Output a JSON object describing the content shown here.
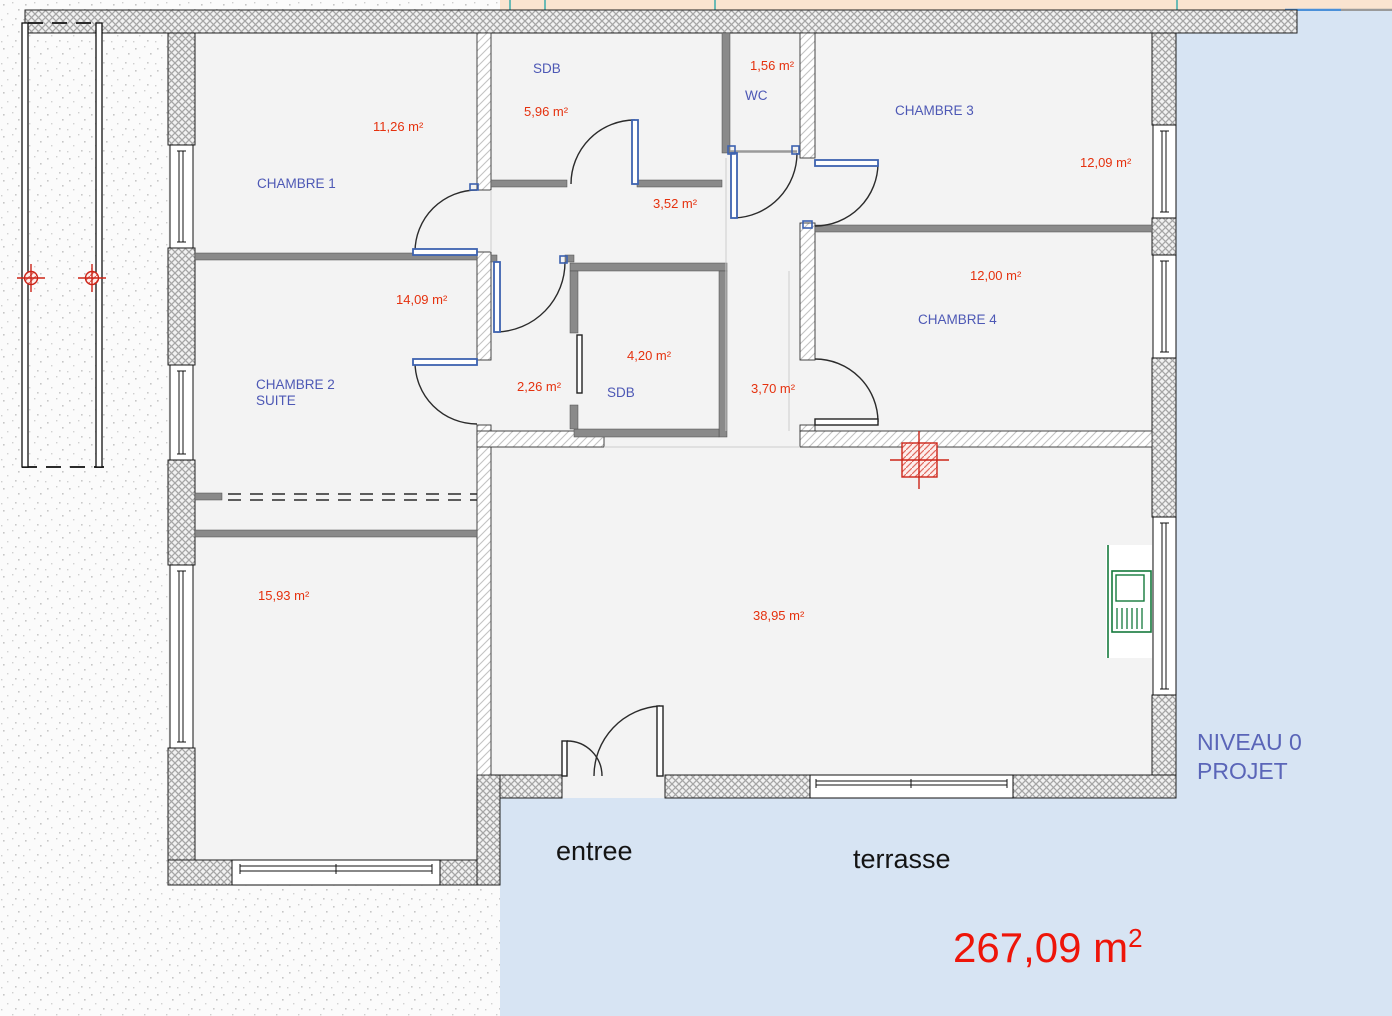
{
  "title": {
    "line1": "NIVEAU 0",
    "line2": "PROJET"
  },
  "total_area": {
    "value": "267,09 m",
    "exponent": "2"
  },
  "outdoor_labels": {
    "entrance": "entree",
    "terrace": "terrasse"
  },
  "rooms": {
    "chambre1": {
      "name": "CHAMBRE 1",
      "area": "11,26 m²"
    },
    "sdb1": {
      "name": "SDB",
      "area": "5,96 m²"
    },
    "wc": {
      "name": "WC",
      "area": "1,56 m²"
    },
    "chambre3": {
      "name": "CHAMBRE 3",
      "area": "12,09 m²"
    },
    "hall": {
      "area": "3,52 m²"
    },
    "chambre2": {
      "name": "CHAMBRE 2",
      "name2": "SUITE",
      "area": "14,09 m²"
    },
    "chambre4": {
      "name": "CHAMBRE 4",
      "area": "12,00 m²"
    },
    "sdb2": {
      "name": "SDB",
      "area": "4,20 m²"
    },
    "vestibule": {
      "area": "2,26 m²"
    },
    "couloir": {
      "area": "3,70 m²"
    },
    "salle": {
      "area": "15,93 m²"
    },
    "sejour": {
      "area": "38,95 m²"
    }
  },
  "colors": {
    "room_name_blue": "#4d58b5",
    "area_red": "#e5310e",
    "total_red": "#ee1509",
    "title_blue": "#5a65b8",
    "terrace_blue": "#d7e4f3",
    "strip_peach": "#fae4d0",
    "floor_gray": "#f3f3f3",
    "partition_gray": "#888888",
    "door_blue": "#3d62b0",
    "stove_green": "#157a3c",
    "column_red": "#cc2418"
  }
}
